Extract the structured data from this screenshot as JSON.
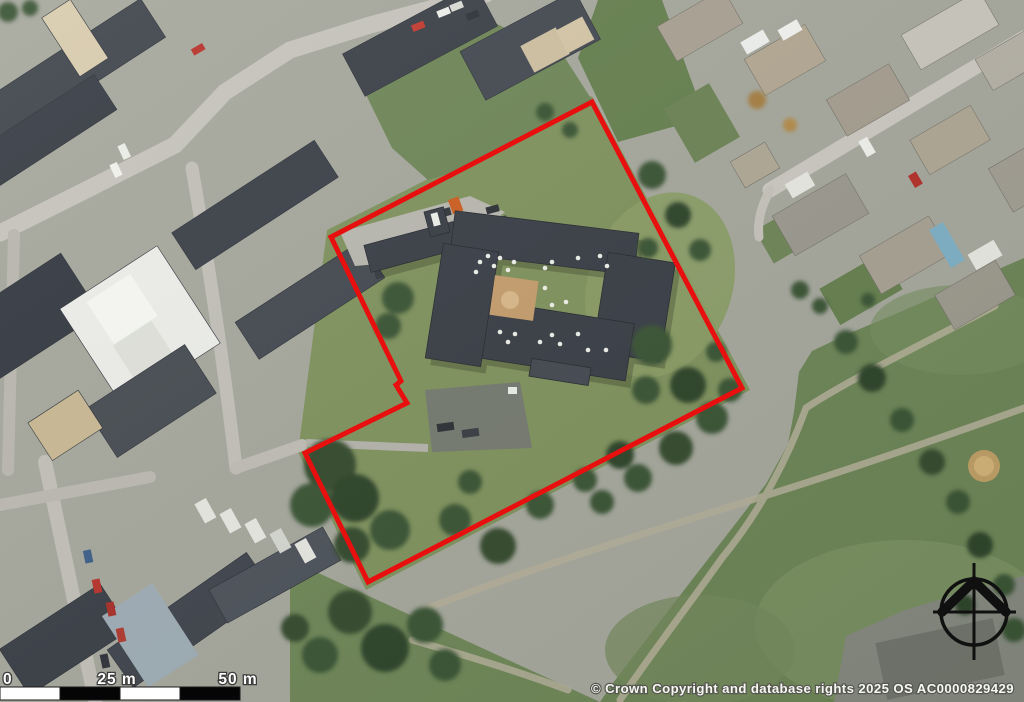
{
  "map": {
    "description": "Aerial photograph of an urban site with a red property boundary outline, scale bar, north compass and Ordnance Survey copyright notice",
    "boundary_color": "#e80f0f",
    "copyright_text": "© Crown Copyright and database rights 2025 OS AC0000829429",
    "scale_bar": {
      "label_0": "0",
      "label_25": "25 m",
      "label_50": "50 m"
    },
    "compass_icon": "north-arrow-compass-rose"
  }
}
